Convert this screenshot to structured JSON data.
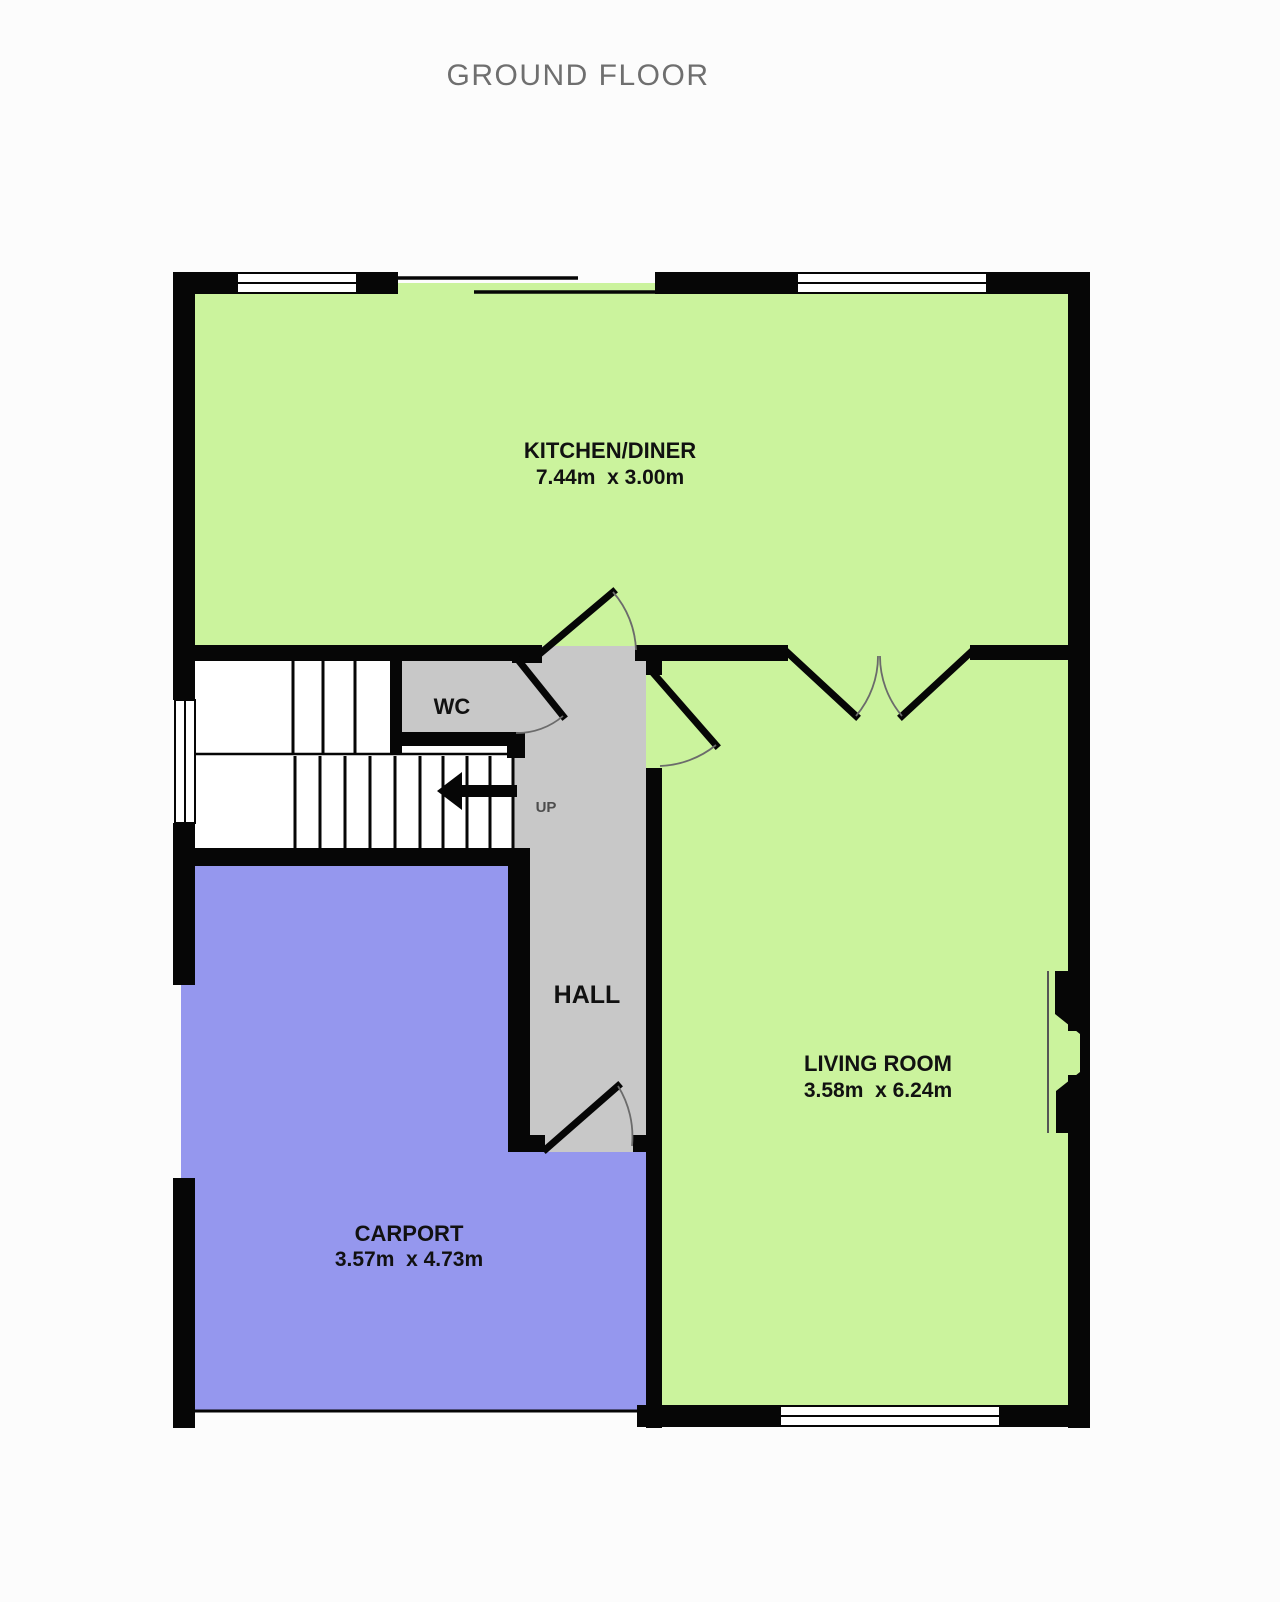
{
  "title": "GROUND FLOOR",
  "rooms": {
    "kitchen": {
      "name": "KITCHEN/DINER",
      "dims": "7.44m  x 3.00m"
    },
    "living": {
      "name": "LIVING ROOM",
      "dims": "3.58m  x 6.24m"
    },
    "carport": {
      "name": "CARPORT",
      "dims": "3.57m  x 4.73m"
    },
    "hall": {
      "name": "HALL"
    },
    "wc": {
      "name": "WC"
    }
  },
  "stairs": {
    "direction_label": "UP"
  },
  "colors": {
    "background": "#fcfcfc",
    "wall": "#060606",
    "room_green": "#cbf39d",
    "carport_blue": "#9597ee",
    "floor_gray": "#c8c8c8",
    "stairs_white": "#ffffff",
    "title_gray": "#6f6f6f",
    "label_dark": "#111111"
  }
}
